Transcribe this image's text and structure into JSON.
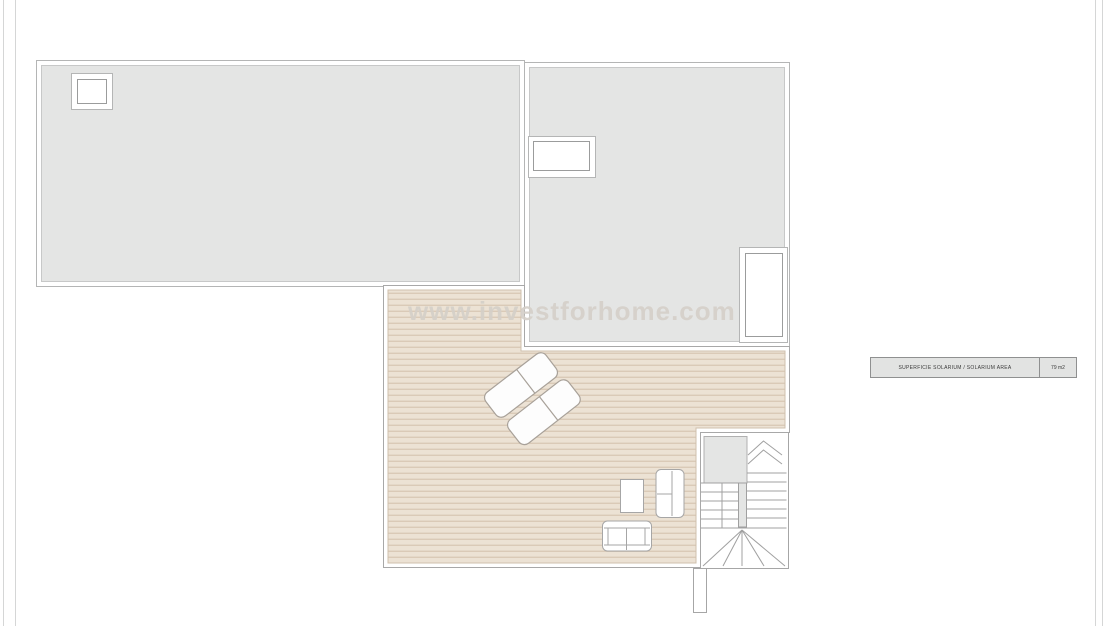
{
  "watermark": {
    "text": "www.investforhome.com"
  },
  "area_table": {
    "label": "SUPERFICIE SOLARIUM / SOLARIUM AREA",
    "value": "79 m2"
  },
  "plan": {
    "type": "floor-plan",
    "level": "solarium / roof terrace",
    "features": [
      "left roof slab with square skylight",
      "right roof slab with rectangular skylight and roof window",
      "striped wood deck terrace",
      "two diagonal sun loungers",
      "coffee table",
      "two-seat sofa (vertical)",
      "two-seat sofa (horizontal)",
      "u-shaped staircase with winders",
      "chimney stub at bottom edge"
    ],
    "colors": {
      "roof_fill": "#e4e5e4",
      "deck_fill": "#ece2d4",
      "deck_stripe": "#dacab7",
      "outline": "#a6a6a6",
      "watermark": "#d5d0c9",
      "label_box_fill": "#e2e3e2"
    }
  }
}
